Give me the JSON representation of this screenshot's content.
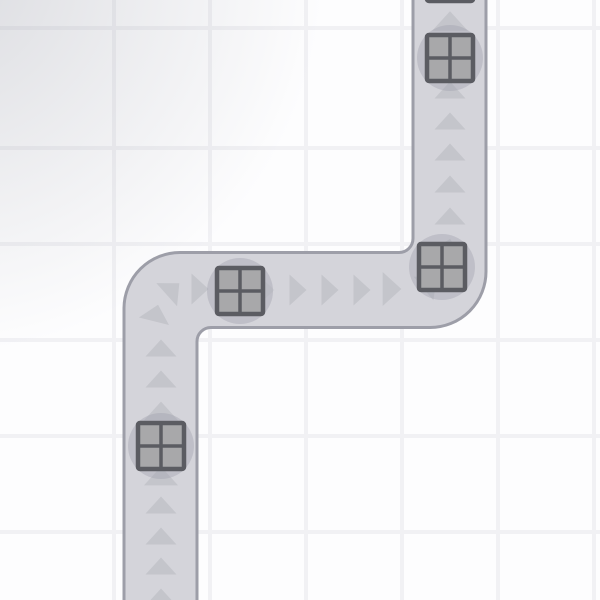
{
  "scene": {
    "board_label": "conveyor path map with crates and direction arrows",
    "background": {
      "color": "#fdfdfe",
      "grid_line_color": "#f1f1f4",
      "grid_size": 96,
      "grid_line_width": 4,
      "grid_offset_x": 16,
      "grid_offset_y": 50,
      "vignette_color": "rgba(138,141,153,0.30)"
    },
    "road": {
      "fill": "#d4d4da",
      "border_color": "#9d9ea8",
      "border_width": 3,
      "path": "M124,612 L124,308 A56,56 0 0 1 180,252.5 L399,252.5 A14,14 0 0 0 413,238.5 L413,-12 L486,-12 L486,271 A56,56 0 0 1 430,327.5 L211,327.5 A14,14 0 0 0 197,341.5 L197,612 Z"
    },
    "arrows": {
      "color": "#c4c5cb",
      "base_width": 31,
      "length": 17,
      "items": [
        {
          "x": 450,
          "y": 21,
          "angle": 0,
          "scale": 1.15
        },
        {
          "x": 450,
          "y": 59,
          "angle": 0
        },
        {
          "x": 450,
          "y": 90,
          "angle": 0
        },
        {
          "x": 450,
          "y": 121,
          "angle": 0
        },
        {
          "x": 450,
          "y": 152,
          "angle": 0
        },
        {
          "x": 450,
          "y": 184,
          "angle": 0
        },
        {
          "x": 450,
          "y": 216,
          "angle": 0
        },
        {
          "x": 448,
          "y": 247,
          "angle": 15
        },
        {
          "x": 430,
          "y": 283,
          "angle": 50
        },
        {
          "x": 392,
          "y": 289,
          "angle": 90,
          "scale": 1.1
        },
        {
          "x": 362,
          "y": 290,
          "angle": 90
        },
        {
          "x": 330,
          "y": 290,
          "angle": 90
        },
        {
          "x": 298,
          "y": 290,
          "angle": 90
        },
        {
          "x": 266,
          "y": 290,
          "angle": 90,
          "opacity": 0.5
        },
        {
          "x": 234,
          "y": 290,
          "angle": 90
        },
        {
          "x": 200,
          "y": 289,
          "angle": 90
        },
        {
          "x": 173,
          "y": 289,
          "angle": 48
        },
        {
          "x": 156,
          "y": 313,
          "angle": 14
        },
        {
          "x": 161,
          "y": 348,
          "angle": 0
        },
        {
          "x": 161,
          "y": 379,
          "angle": 0
        },
        {
          "x": 161,
          "y": 411,
          "angle": 0,
          "scale": 1.1
        },
        {
          "x": 161,
          "y": 443,
          "angle": 0
        },
        {
          "x": 161,
          "y": 476,
          "angle": 0,
          "scale": 1.1
        },
        {
          "x": 161,
          "y": 505,
          "angle": 0
        },
        {
          "x": 161,
          "y": 536,
          "angle": 0
        },
        {
          "x": 161,
          "y": 566,
          "angle": 0
        },
        {
          "x": 161,
          "y": 597,
          "angle": 0
        }
      ]
    },
    "crates": {
      "fill": "#a8a8aa",
      "border_color": "#5b5c62",
      "border_width": 4.5,
      "divider_width": 3.5,
      "size": 46,
      "corner_radius": 2,
      "shadow_color": "#9fa0ac",
      "shadow_opacity": 0.4,
      "shadow_radius": 33,
      "items": [
        {
          "x": 450,
          "y": -22,
          "shadow": false
        },
        {
          "x": 450,
          "y": 58
        },
        {
          "x": 442,
          "y": 267
        },
        {
          "x": 240,
          "y": 291
        },
        {
          "x": 161,
          "y": 446
        }
      ]
    }
  }
}
